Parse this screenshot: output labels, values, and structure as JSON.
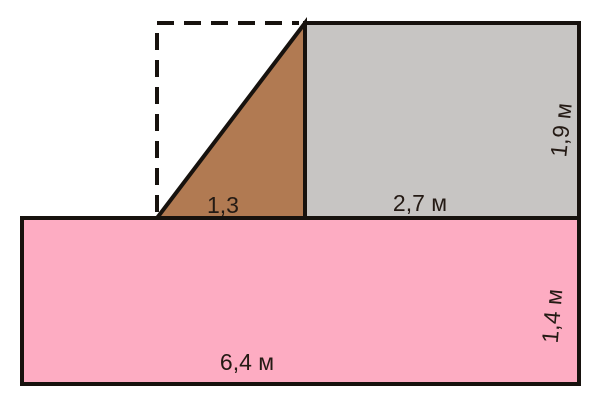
{
  "diagram": {
    "shapes": {
      "pink_rectangle": {
        "fill": "#FDACC2",
        "width_label": "6,4 м",
        "height_label": "1,4 м"
      },
      "gray_rectangle": {
        "fill": "#C7C5C3",
        "width_label": "2,7 м",
        "height_label": "1,9 м"
      },
      "brown_triangle": {
        "fill": "#B17A52",
        "base_label": "1,3"
      }
    },
    "colors": {
      "outline": "#17120E",
      "background": "#FFFFFF",
      "label_text": "#241A14"
    }
  }
}
